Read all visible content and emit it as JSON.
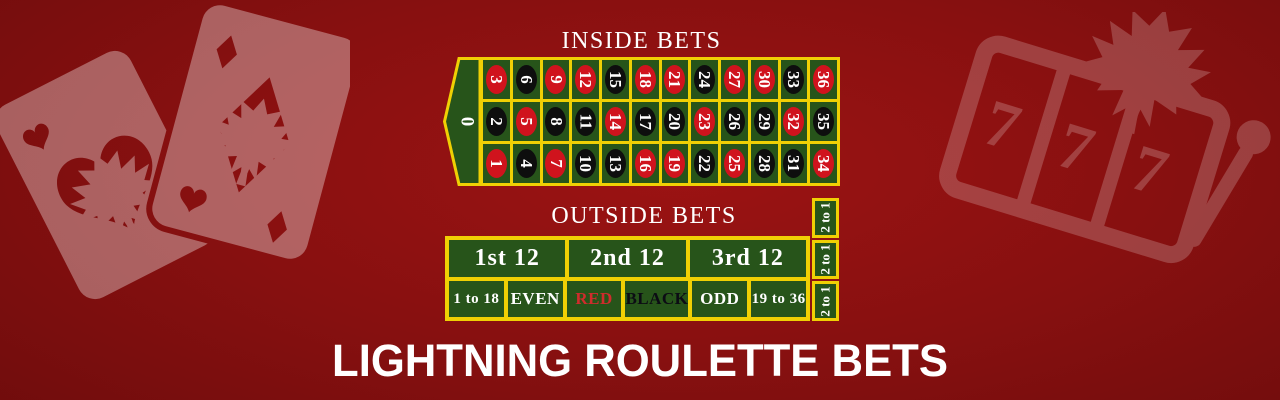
{
  "banner": {
    "title": "LIGHTNING ROULETTE BETS"
  },
  "colors": {
    "felt_green": "#27541a",
    "line_yellow": "#f0d004",
    "pocket_red": "#d0131d",
    "pocket_black": "#0e0e0e",
    "red_label_text": "#d02c2c",
    "background_center": "#9c1313",
    "background_edge": "#520707"
  },
  "inside": {
    "title": "INSIDE BETS",
    "zero": "0",
    "rows": [
      [
        {
          "n": "3",
          "color": "red"
        },
        {
          "n": "6",
          "color": "black"
        },
        {
          "n": "9",
          "color": "red"
        },
        {
          "n": "12",
          "color": "red"
        },
        {
          "n": "15",
          "color": "black"
        },
        {
          "n": "18",
          "color": "red"
        },
        {
          "n": "21",
          "color": "red"
        },
        {
          "n": "24",
          "color": "black"
        },
        {
          "n": "27",
          "color": "red"
        },
        {
          "n": "30",
          "color": "red"
        },
        {
          "n": "33",
          "color": "black"
        },
        {
          "n": "36",
          "color": "red"
        }
      ],
      [
        {
          "n": "2",
          "color": "black"
        },
        {
          "n": "5",
          "color": "red"
        },
        {
          "n": "8",
          "color": "black"
        },
        {
          "n": "11",
          "color": "black"
        },
        {
          "n": "14",
          "color": "red"
        },
        {
          "n": "17",
          "color": "black"
        },
        {
          "n": "20",
          "color": "black"
        },
        {
          "n": "23",
          "color": "red"
        },
        {
          "n": "26",
          "color": "black"
        },
        {
          "n": "29",
          "color": "black"
        },
        {
          "n": "32",
          "color": "red"
        },
        {
          "n": "35",
          "color": "black"
        }
      ],
      [
        {
          "n": "1",
          "color": "red"
        },
        {
          "n": "4",
          "color": "black"
        },
        {
          "n": "7",
          "color": "red"
        },
        {
          "n": "10",
          "color": "black"
        },
        {
          "n": "13",
          "color": "black"
        },
        {
          "n": "16",
          "color": "red"
        },
        {
          "n": "19",
          "color": "red"
        },
        {
          "n": "22",
          "color": "black"
        },
        {
          "n": "25",
          "color": "red"
        },
        {
          "n": "28",
          "color": "black"
        },
        {
          "n": "31",
          "color": "black"
        },
        {
          "n": "34",
          "color": "red"
        }
      ]
    ]
  },
  "outside": {
    "title": "OUTSIDE BETS",
    "dozens": [
      "1st 12",
      "2nd 12",
      "3rd 12"
    ],
    "even_money": [
      {
        "label": "1 to 18",
        "style": "white",
        "small": true
      },
      {
        "label": "EVEN",
        "style": "white",
        "small": false
      },
      {
        "label": "RED",
        "style": "red",
        "small": false
      },
      {
        "label": "BLACK",
        "style": "black",
        "small": false
      },
      {
        "label": "ODD",
        "style": "white",
        "small": false
      },
      {
        "label": "19 to 36",
        "style": "white",
        "small": true
      }
    ],
    "column_bets": [
      "2 to 1",
      "2 to 1",
      "2 to 1"
    ]
  },
  "decor": {
    "left_icon": "playing-cards-with-maple-leaf",
    "right_icon": "slot-machine-777-with-maple-leaf",
    "sevens": [
      "7",
      "7",
      "7"
    ]
  }
}
